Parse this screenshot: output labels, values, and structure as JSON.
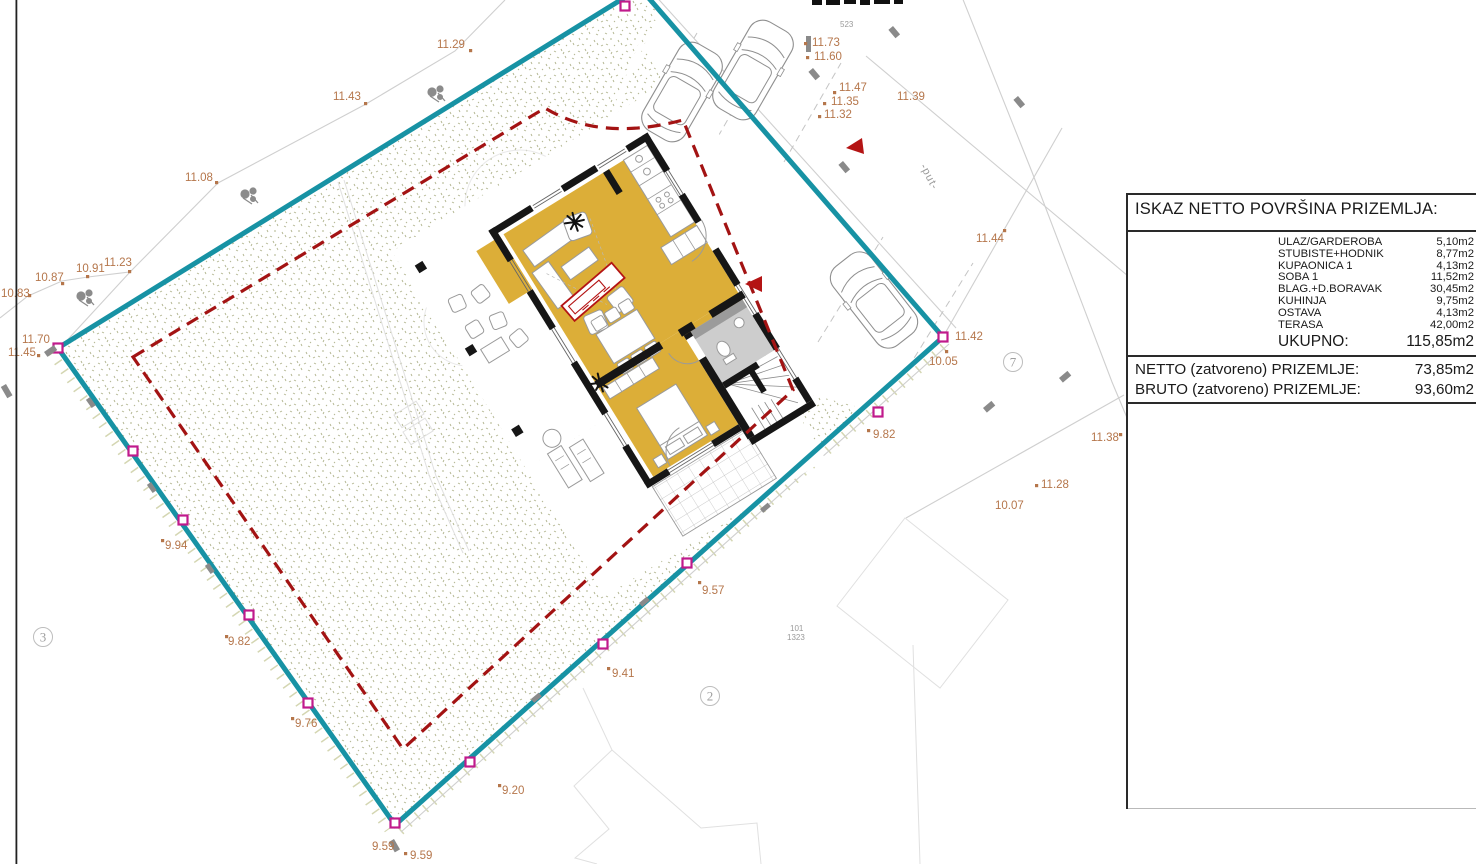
{
  "drawing": {
    "compass_letter": "S",
    "road_label": "-put-",
    "cadastral_refs": [
      {
        "v": "523",
        "x": 840,
        "y": 27
      },
      {
        "v": "101",
        "x": 790,
        "y": 631
      },
      {
        "v": "1323",
        "x": 787,
        "y": 640
      }
    ],
    "parcel_numbers": [
      {
        "n": "3",
        "x": 43,
        "y": 637
      },
      {
        "n": "2",
        "x": 710,
        "y": 696
      },
      {
        "n": "7",
        "x": 1013,
        "y": 362
      }
    ],
    "elevations": [
      {
        "v": "11.29",
        "x": 437,
        "y": 48,
        "dot": [
          469,
          49
        ]
      },
      {
        "v": "11.43",
        "x": 333,
        "y": 100,
        "dot": [
          364,
          102
        ]
      },
      {
        "v": "11.08",
        "x": 185,
        "y": 181,
        "dot": [
          215,
          181
        ]
      },
      {
        "v": "10.87",
        "x": 35,
        "y": 281,
        "dot": [
          61,
          282
        ]
      },
      {
        "v": "10.91",
        "x": 76,
        "y": 272,
        "dot": [
          86,
          275
        ]
      },
      {
        "v": "11.23",
        "x": 104,
        "y": 266,
        "dot": [
          128,
          270
        ]
      },
      {
        "v": "10.83",
        "x": 1,
        "y": 297,
        "dot": [
          28,
          294
        ]
      },
      {
        "v": "11.70",
        "x": 22,
        "y": 343
      },
      {
        "v": "11.45",
        "x": 8,
        "y": 356,
        "dot": [
          37,
          354
        ]
      },
      {
        "v": "11.73",
        "x": 812,
        "y": 46,
        "dot": [
          804,
          42
        ]
      },
      {
        "v": "11.60",
        "x": 814,
        "y": 60,
        "dot": [
          806,
          56
        ]
      },
      {
        "v": "11.47",
        "x": 839,
        "y": 91,
        "dot": [
          833,
          91
        ]
      },
      {
        "v": "11.35",
        "x": 831,
        "y": 105,
        "dot": [
          823,
          102
        ]
      },
      {
        "v": "11.32",
        "x": 824,
        "y": 118,
        "dot": [
          818,
          115
        ]
      },
      {
        "v": "11.39",
        "x": 897,
        "y": 100
      },
      {
        "v": "11.44",
        "x": 976,
        "y": 242,
        "dot": [
          1003,
          229
        ]
      },
      {
        "v": "11.42",
        "x": 955,
        "y": 340
      },
      {
        "v": "10.05",
        "x": 929,
        "y": 365,
        "dot": [
          945,
          350
        ]
      },
      {
        "v": "9.82",
        "x": 873,
        "y": 438,
        "dot": [
          867,
          429
        ]
      },
      {
        "v": "11.38",
        "x": 1091,
        "y": 441,
        "dot": [
          1119,
          433
        ]
      },
      {
        "v": "11.28",
        "x": 1041,
        "y": 488,
        "dot": [
          1035,
          484
        ]
      },
      {
        "v": "10.07",
        "x": 995,
        "y": 509
      },
      {
        "v": "9.94",
        "x": 165,
        "y": 549,
        "dot": [
          161,
          539
        ]
      },
      {
        "v": "9.82",
        "x": 228,
        "y": 645,
        "dot": [
          225,
          635
        ]
      },
      {
        "v": "9.76",
        "x": 295,
        "y": 727,
        "dot": [
          291,
          717
        ]
      },
      {
        "v": "9.20",
        "x": 502,
        "y": 794,
        "dot": [
          498,
          784
        ]
      },
      {
        "v": "9.59",
        "x": 372,
        "y": 850
      },
      {
        "v": "9.59",
        "x": 410,
        "y": 859,
        "dot": [
          404,
          852
        ]
      },
      {
        "v": "9.41",
        "x": 612,
        "y": 677,
        "dot": [
          607,
          667
        ]
      },
      {
        "v": "9.57",
        "x": 702,
        "y": 594,
        "dot": [
          698,
          581
        ]
      }
    ]
  },
  "area_table": {
    "title": "ISKAZ NETTO POVRŠINA PRIZEMLJA:",
    "rows": [
      {
        "name": "ULAZ/GARDEROBA",
        "value": "5,10m2"
      },
      {
        "name": "STUBISTE+HODNIK",
        "value": "8,77m2"
      },
      {
        "name": "KUPAONICA 1",
        "value": "4,13m2"
      },
      {
        "name": "SOBA 1",
        "value": "11,52m2"
      },
      {
        "name": "BLAG.+D.BORAVAK",
        "value": "30,45m2"
      },
      {
        "name": "KUHINJA",
        "value": "9,75m2"
      },
      {
        "name": "OSTAVA",
        "value": "4,13m2"
      },
      {
        "name": "TERASA",
        "value": "42,00m2"
      }
    ],
    "total": {
      "name": "UKUPNO:",
      "value": "115,85m2"
    },
    "summary": [
      {
        "name": "NETTO (zatvoreno) PRIZEMLJE:",
        "value": "73,85m2"
      },
      {
        "name": "BRUTO (zatvoreno) PRIZEMLJE:",
        "value": "93,60m2"
      }
    ]
  },
  "colors": {
    "boundary_teal": "#1792a4",
    "setback_red": "#a31313",
    "room_yellow": "#dcae38",
    "wall_black": "#161616",
    "elevation_brown": "#b5764b",
    "marker_magenta": "#c01a8c",
    "terrain_speckle": "#a9ac82"
  }
}
